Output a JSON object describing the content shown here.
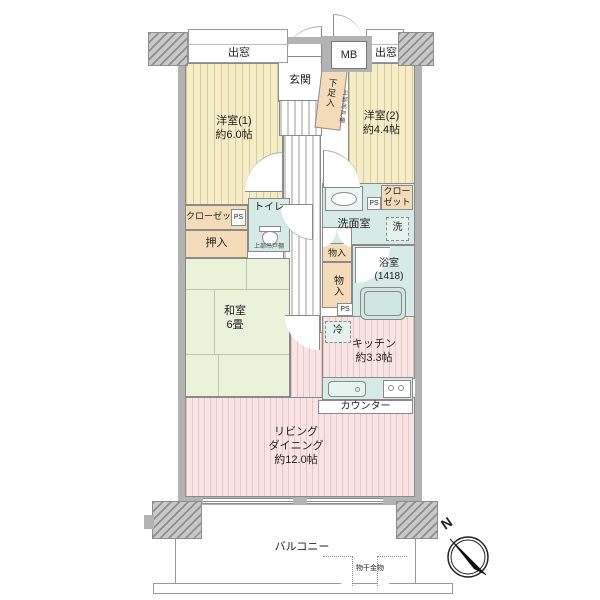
{
  "labels": {
    "bay_window_left": "出窓",
    "bay_window_right": "出窓",
    "meter_box": "MB",
    "entrance": "玄関",
    "shoe_cabinet": "下足入",
    "upper_cabinet_entrance": "上部吊戸棚",
    "upper_cabinet_toilet": "上部吊戸棚",
    "western_room_1": {
      "name": "洋室(1)",
      "size": "約6.0帖"
    },
    "western_room_2": {
      "name": "洋室(2)",
      "size": "約4.4帖"
    },
    "closet_left": "クローゼット",
    "closet_right": {
      "line1": "クロー",
      "line2": "ゼット"
    },
    "ps": "PS",
    "oshiire": "押入",
    "toilet": "トイレ",
    "washroom": "洗面室",
    "washer": "洗",
    "storage_upper": "物入",
    "storage_lower": "物入",
    "bathroom": {
      "name": "浴室",
      "size": "(1418)"
    },
    "japanese_room": {
      "name": "和室",
      "size": "6畳"
    },
    "fridge": "冷",
    "kitchen": {
      "name": "キッチン",
      "size": "約3.3帖"
    },
    "counter": "カウンター",
    "living": {
      "line1": "リビング",
      "line2": "ダイニング",
      "size": "約12.0帖"
    },
    "balcony": "バルコニー",
    "laundry_fitting": "物干金物",
    "north": "N"
  },
  "colors": {
    "wall_gray": "#b3b3b3",
    "western_room_fill": "#f5ecc8",
    "living_kitchen_fill": "#f8e4e2",
    "japanese_room_fill": "#eaf3da",
    "wet_area_fill": "#d6ebe5",
    "storage_fill": "#f4dcba",
    "outline": "#8a8a8a"
  }
}
